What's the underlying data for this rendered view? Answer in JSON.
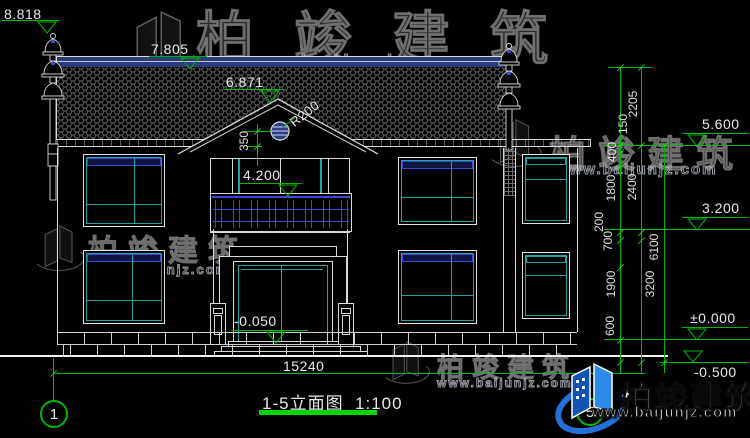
{
  "watermark": {
    "brand": "柏竣建筑",
    "url": "www.baijunjz.com"
  },
  "title_block": {
    "name": "1-5立面图",
    "scale": "1:100"
  },
  "axes": {
    "left": "1",
    "right": "5"
  },
  "levels_left": {
    "l1": "8.818",
    "l2": "7.805",
    "l3": "6.871",
    "l4": "4.200",
    "l5": "-0.050"
  },
  "levels_right": {
    "r1": "5.600",
    "r2": "3.200",
    "r3": "±0.000",
    "r4": "-0.500"
  },
  "dims": {
    "overall": "15240",
    "radius": "R200",
    "offset350": "350",
    "chain_a": [
      "2205",
      "150",
      "400",
      "1800",
      "200",
      "700",
      "1900",
      "600"
    ],
    "chain_b": [
      "2400",
      "3200"
    ],
    "total": "6100"
  }
}
